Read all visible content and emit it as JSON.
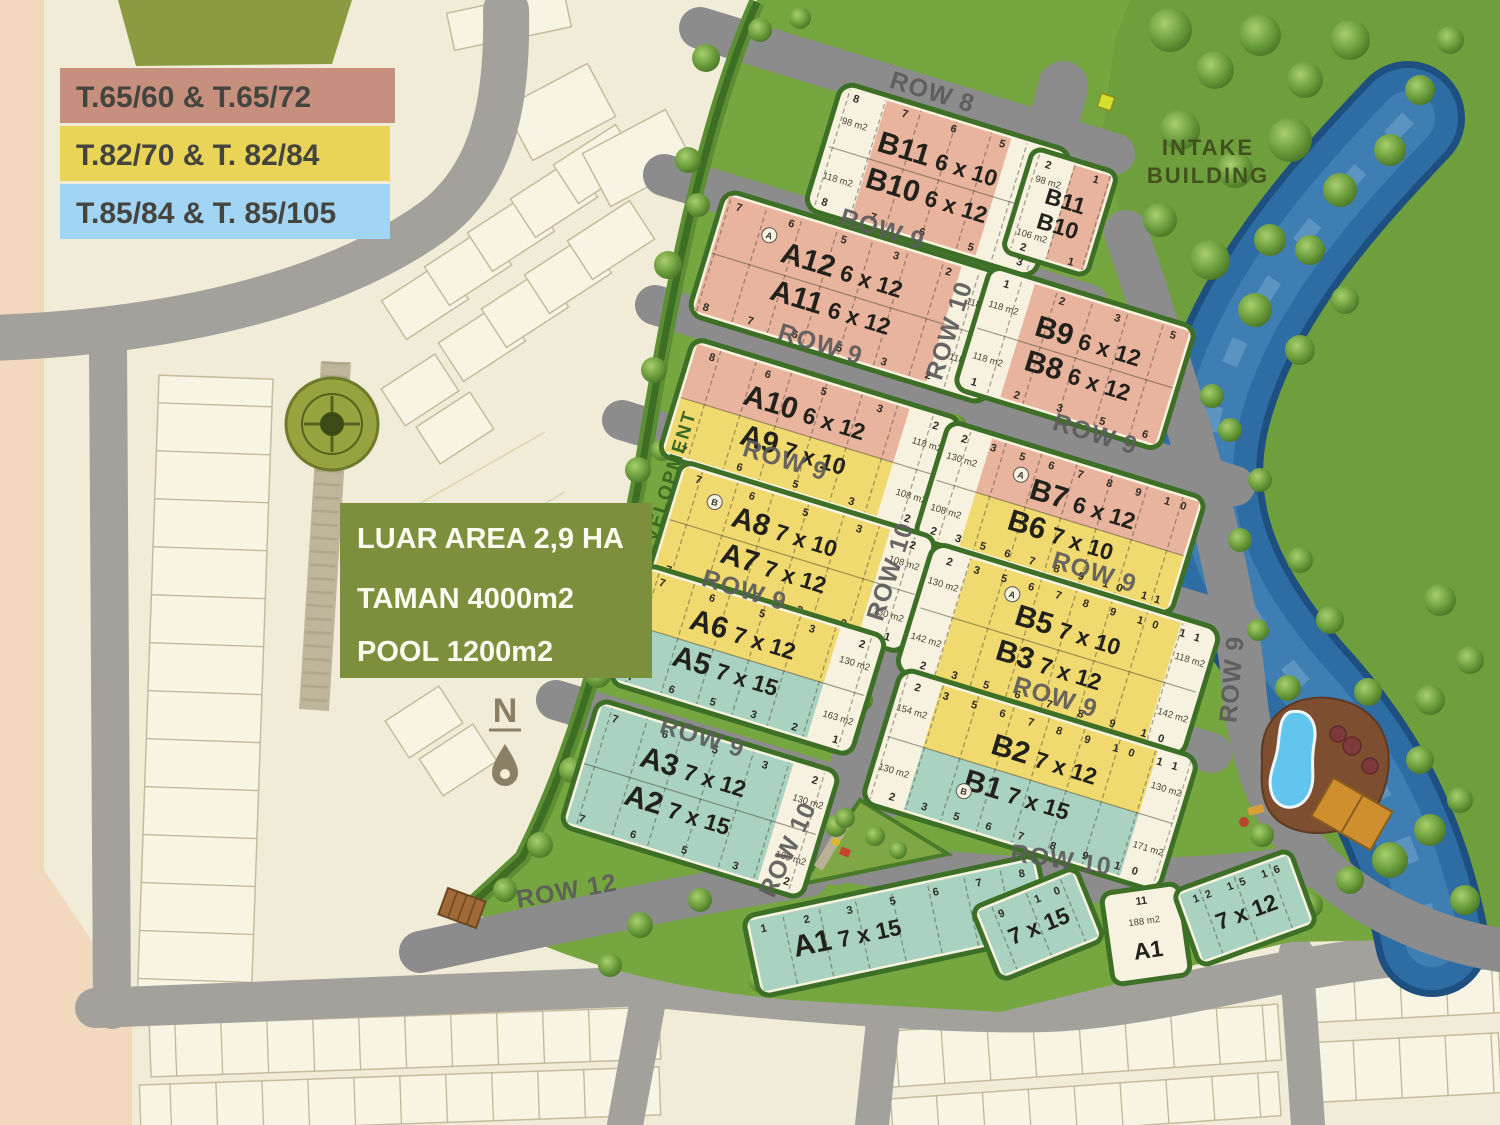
{
  "legend": {
    "items": [
      {
        "label": "T.65/60 & T.65/72",
        "color": "#c78f7d"
      },
      {
        "label": "T.82/70 & T. 82/84",
        "color": "#e9d457"
      },
      {
        "label": "T.85/84 & T. 85/105",
        "color": "#a2d5f3"
      }
    ]
  },
  "info": {
    "bg": "#7b8f3c",
    "lines": [
      "LUAR AREA  2,9 HA",
      "TAMAN 4000m2",
      "POOL 1200m2"
    ]
  },
  "labels": {
    "intake_line1": "INTAKE",
    "intake_line2": "BUILDING",
    "development": "DEVELOPMENT",
    "north_n": "N"
  },
  "rows": {
    "row8": "ROW 8",
    "row9": "ROW 9",
    "row10": "ROW 10",
    "row12": "ROW 12"
  },
  "unit_markers": {
    "a": "A",
    "b": "B"
  },
  "palette": {
    "lot_pink": "#e9b49d",
    "lot_yellow": "#f0d96e",
    "lot_teal": "#a9d3c0",
    "lot_white": "#f6f2df",
    "road": "#8c8c8c",
    "grass": "#76a63f",
    "river": "#2e6da4",
    "hedge": "#3d7026",
    "info_green": "#7b8f3c"
  },
  "blocks": {
    "b11b10_main": {
      "name1": "B11",
      "dim1": "6 x 10",
      "name2": "B10",
      "dim2": "6 x 12",
      "top_lots": [
        8,
        7,
        6,
        5,
        3
      ],
      "bottom_lots": [
        8,
        7,
        6,
        5,
        3
      ],
      "areas": [
        "98 m2",
        "118 m2",
        "98 m2",
        "118 m2"
      ]
    },
    "b11b10_small": {
      "name1": "B11",
      "name2": "B10",
      "top_lots": [
        2,
        1
      ],
      "bottom_lots": [
        2,
        1
      ],
      "areas": [
        "98 m2",
        "106 m2"
      ]
    },
    "a12a11": {
      "name1": "A12",
      "dim1": "6 x 12",
      "name2": "A11",
      "dim2": "6 x 12",
      "top_lots": [
        7,
        6,
        5,
        3,
        2,
        1
      ],
      "bottom_lots": [
        8,
        7,
        6,
        5,
        3,
        2,
        1
      ],
      "areas": [
        "118 m2",
        "118 m2"
      ]
    },
    "b9b8": {
      "name1": "B9",
      "dim1": "6 x 12",
      "name2": "B8",
      "dim2": "6 x 12",
      "top_lots": [
        1,
        2,
        3,
        5
      ],
      "bottom_lots": [
        1,
        2,
        3,
        5,
        6
      ],
      "areas": [
        "118 m2",
        "118 m2"
      ]
    },
    "a10a9": {
      "name1": "A10",
      "dim1": "6 x 12",
      "name2": "A9",
      "dim2": "7 x 10",
      "top_lots": [
        8,
        6,
        5,
        3,
        2
      ],
      "bottom_lots": [
        7,
        6,
        5,
        3,
        2
      ],
      "areas": [
        "118 m2",
        "108 m2"
      ]
    },
    "b7b6": {
      "name1": "B7",
      "dim1": "6 x 12",
      "name2": "B6",
      "dim2": "7 x 10",
      "top_lots": [
        2,
        3,
        5,
        6,
        7,
        8,
        9,
        10
      ],
      "bottom_lots": [
        2,
        3,
        5,
        6,
        7,
        8,
        9,
        10,
        11
      ],
      "areas": [
        "130 m2",
        "108 m2"
      ]
    },
    "a8a7": {
      "name1": "A8",
      "dim1": "7 x 10",
      "name2": "A7",
      "dim2": "7 x 12",
      "top_lots": [
        7,
        6,
        5,
        3,
        2
      ],
      "bottom_lots": [
        7,
        6,
        5,
        3,
        2,
        1
      ],
      "areas": [
        "108 m2",
        "130 m2"
      ]
    },
    "a6a5": {
      "name1": "A6",
      "dim1": "7 x 12",
      "name2": "A5",
      "dim2": "7 x 15",
      "top_lots": [
        7,
        6,
        5,
        3,
        2
      ],
      "bottom_lots": [
        7,
        6,
        5,
        3,
        2,
        1
      ],
      "areas": [
        "130 m2",
        "163 m2"
      ]
    },
    "b5b3": {
      "name1": "B5",
      "dim1": "7 x 10",
      "name2": "B3",
      "dim2": "7 x 12",
      "top_lots": [
        2,
        3,
        5,
        6,
        7,
        8,
        9,
        10,
        11
      ],
      "bottom_lots": [
        2,
        3,
        5,
        6,
        7,
        8,
        9,
        10
      ],
      "areas": [
        "130 m2",
        "142 m2",
        "118 m2",
        "142 m2"
      ]
    },
    "b2b1": {
      "name1": "B2",
      "dim1": "7 x 12",
      "name2": "B1",
      "dim2": "7 x 15",
      "top_lots": [
        2,
        3,
        5,
        6,
        7,
        8,
        9,
        10,
        11
      ],
      "bottom_lots": [
        2,
        3,
        5,
        6,
        7,
        8,
        9,
        10
      ],
      "areas": [
        "154 m2",
        "130 m2",
        "130 m2",
        "171 m2"
      ]
    },
    "a3a2": {
      "name1": "A3",
      "dim1": "7 x 12",
      "name2": "A2",
      "dim2": "7 x 15",
      "top_lots": [
        7,
        6,
        5,
        3,
        2
      ],
      "bottom_lots": [
        7,
        6,
        5,
        3,
        2
      ],
      "areas": [
        "130 m2",
        "135 m2"
      ]
    },
    "a1_strip": {
      "name1": "A1",
      "dim1": "7 x 15",
      "top_lots": [
        1,
        2,
        3,
        5,
        6,
        7,
        8
      ]
    },
    "a1_east_7x15": {
      "dim1": "7 x 15",
      "top_lots": [
        9,
        10
      ]
    },
    "a1_corner": {
      "name1": "A1",
      "lot": "11",
      "area": "188 m2"
    },
    "a1_east_7x12": {
      "dim1": "7 x 12",
      "top_lots": [
        12,
        15,
        16
      ]
    }
  }
}
